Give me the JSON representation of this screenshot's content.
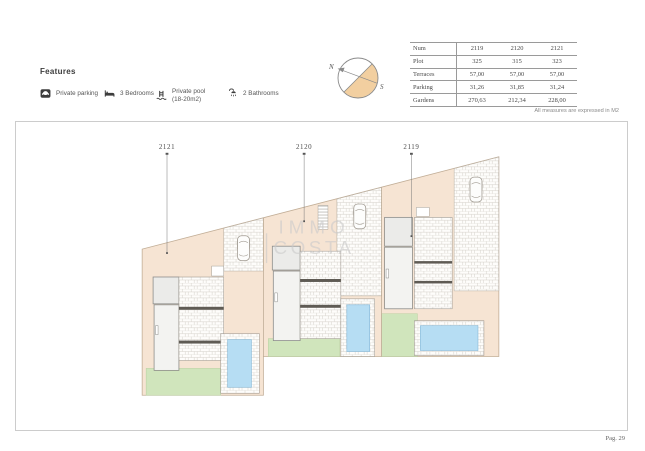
{
  "features": {
    "title": "Features",
    "items": [
      {
        "icon": "parking-icon",
        "label": "Private parking"
      },
      {
        "icon": "bed-icon",
        "label": "3 Bedrooms"
      },
      {
        "icon": "pool-icon",
        "label": "Private pool",
        "label2": "(18-20m2)"
      },
      {
        "icon": "bath-icon",
        "label": "2 Bathrooms"
      }
    ]
  },
  "compass": {
    "north_label": "N",
    "south_label": "S"
  },
  "table": {
    "header": {
      "label": "Num",
      "columns": [
        "2119",
        "2120",
        "2121"
      ]
    },
    "rows": [
      {
        "label": "Plot",
        "values": [
          "325",
          "315",
          "323"
        ]
      },
      {
        "label": "Terraces",
        "values": [
          "57,00",
          "57,00",
          "57,00"
        ]
      },
      {
        "label": "Parking",
        "values": [
          "31,26",
          "31,85",
          "31,24"
        ]
      },
      {
        "label": "Gardens",
        "values": [
          "270,63",
          "212,34",
          "228,00"
        ]
      }
    ],
    "note": "All measures are expressed in M2"
  },
  "plan": {
    "plots": [
      {
        "id": "2121"
      },
      {
        "id": "2120"
      },
      {
        "id": "2119"
      }
    ],
    "watermark": {
      "line1": "IMMO",
      "line2": "COSTA"
    },
    "colors": {
      "plot_tan": "#f6e4d3",
      "pool_blue": "#b6ddf3",
      "garden_green": "#d0e5bc",
      "compass_fill": "#f2cfa0",
      "watermark_gray": "#cbcbcb"
    }
  },
  "footer": {
    "page_label": "Pag. 29"
  }
}
